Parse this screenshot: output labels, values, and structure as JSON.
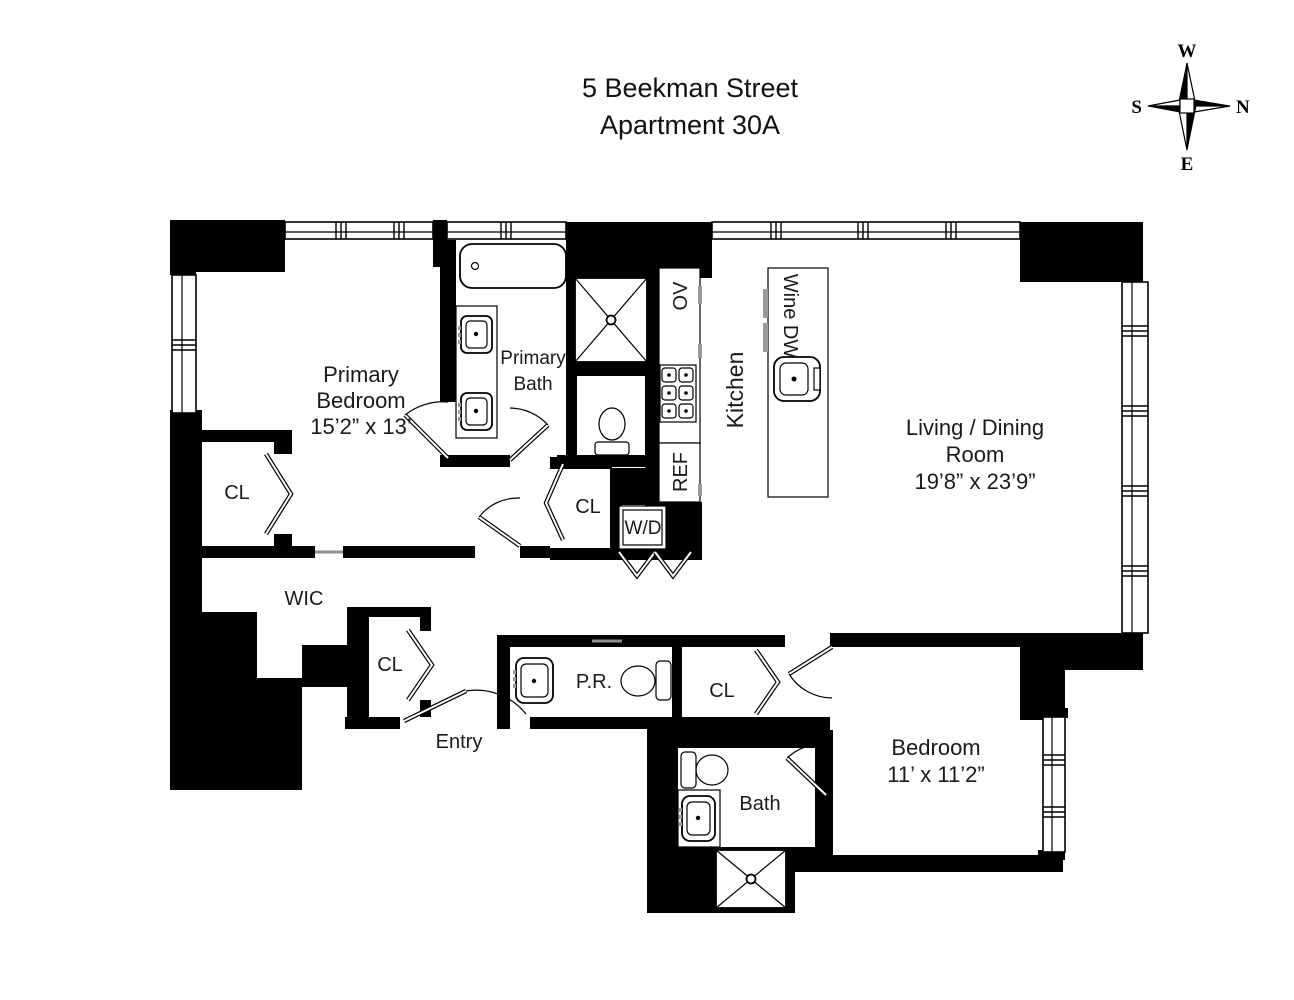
{
  "title": {
    "line1": "5 Beekman Street",
    "line2": "Apartment 30A"
  },
  "compass": {
    "top": "W",
    "right": "N",
    "left": "S",
    "bottom": "E"
  },
  "rooms": {
    "primary_bedroom": {
      "line1": "Primary",
      "line2": "Bedroom",
      "dims": "15’2” x 13’"
    },
    "primary_bath": {
      "line1": "Primary",
      "line2": "Bath"
    },
    "living_dining": {
      "line1": "Living / Dining",
      "line2": "Room",
      "dims": "19’8” x 23’9”"
    },
    "kitchen": {
      "label": "Kitchen"
    },
    "bedroom": {
      "line1": "Bedroom",
      "dims": "11’ x 11’2”"
    },
    "bath": {
      "label": "Bath"
    },
    "powder_room": {
      "label": "P.R."
    },
    "wic": {
      "label": "WIC"
    },
    "entry": {
      "label": "Entry"
    }
  },
  "closets": {
    "primary_closet": "CL",
    "hall_closet": "CL",
    "entry_closet": "CL",
    "bedroom_closet": "CL"
  },
  "appliances": {
    "oven": "OV",
    "refrigerator": "REF",
    "wine_dw": "Wine DW",
    "washer_dryer": "W/D"
  }
}
